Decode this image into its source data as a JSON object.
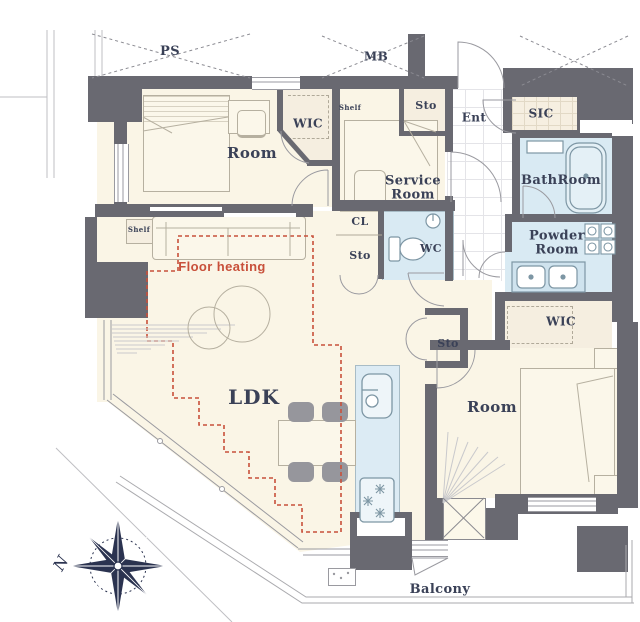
{
  "title": "Apartment floor plan",
  "labels": {
    "ps": "PS",
    "mb": "MB",
    "room_top": "Room",
    "wic_top": "WIC",
    "shelf_top": "Shelf",
    "shelf_left": "Shelf",
    "sto_hall": "Sto",
    "ent": "Ent",
    "sic": "SIC",
    "service_room": "Service Room",
    "bathroom": "BathRoom",
    "cl": "CL",
    "sto_mid": "Sto",
    "wc": "WC",
    "powder_room": "Powder Room",
    "wic_right": "WIC",
    "sto_right": "Sto",
    "room_right": "Room",
    "ldk": "LDK",
    "floor_heating": "Floor heating",
    "balcony": "Balcony",
    "compass_north": "N"
  },
  "rooms": [
    {
      "name": "LDK",
      "features": [
        "floor heating zone",
        "kitchen counter with sink and stove",
        "dining table with 4 chairs",
        "sofa",
        "round tables"
      ]
    },
    {
      "name": "Room (upper left)",
      "features": [
        "double bed",
        "desk and chair",
        "WIC",
        "shelf"
      ]
    },
    {
      "name": "Service Room",
      "features": [
        "single bed",
        "desk"
      ]
    },
    {
      "name": "Room (right)",
      "features": [
        "double bed",
        "nightstands",
        "WIC",
        "Sto"
      ]
    },
    {
      "name": "BathRoom",
      "features": [
        "bathtub",
        "vanity"
      ]
    },
    {
      "name": "Powder Room",
      "features": [
        "double sink",
        "washer area"
      ]
    },
    {
      "name": "WC",
      "features": [
        "toilet",
        "hand basin"
      ]
    },
    {
      "name": "Ent",
      "features": [
        "tiled entrance",
        "SIC",
        "Sto"
      ]
    },
    {
      "name": "Balcony",
      "features": [
        "wraps lower edge",
        "compass rose outside"
      ]
    }
  ],
  "colors": {
    "wall": "#696971",
    "floor_cream": "#faf5e6",
    "closet_cream": "#f5eee0",
    "wet_area_blue": "#d9eaf3",
    "kitchen_blue": "#dcebf4",
    "heating_red": "#c8503a",
    "label_navy": "#3a4157",
    "line_gray": "#9a9aa0",
    "compass_navy": "#2b3350"
  }
}
